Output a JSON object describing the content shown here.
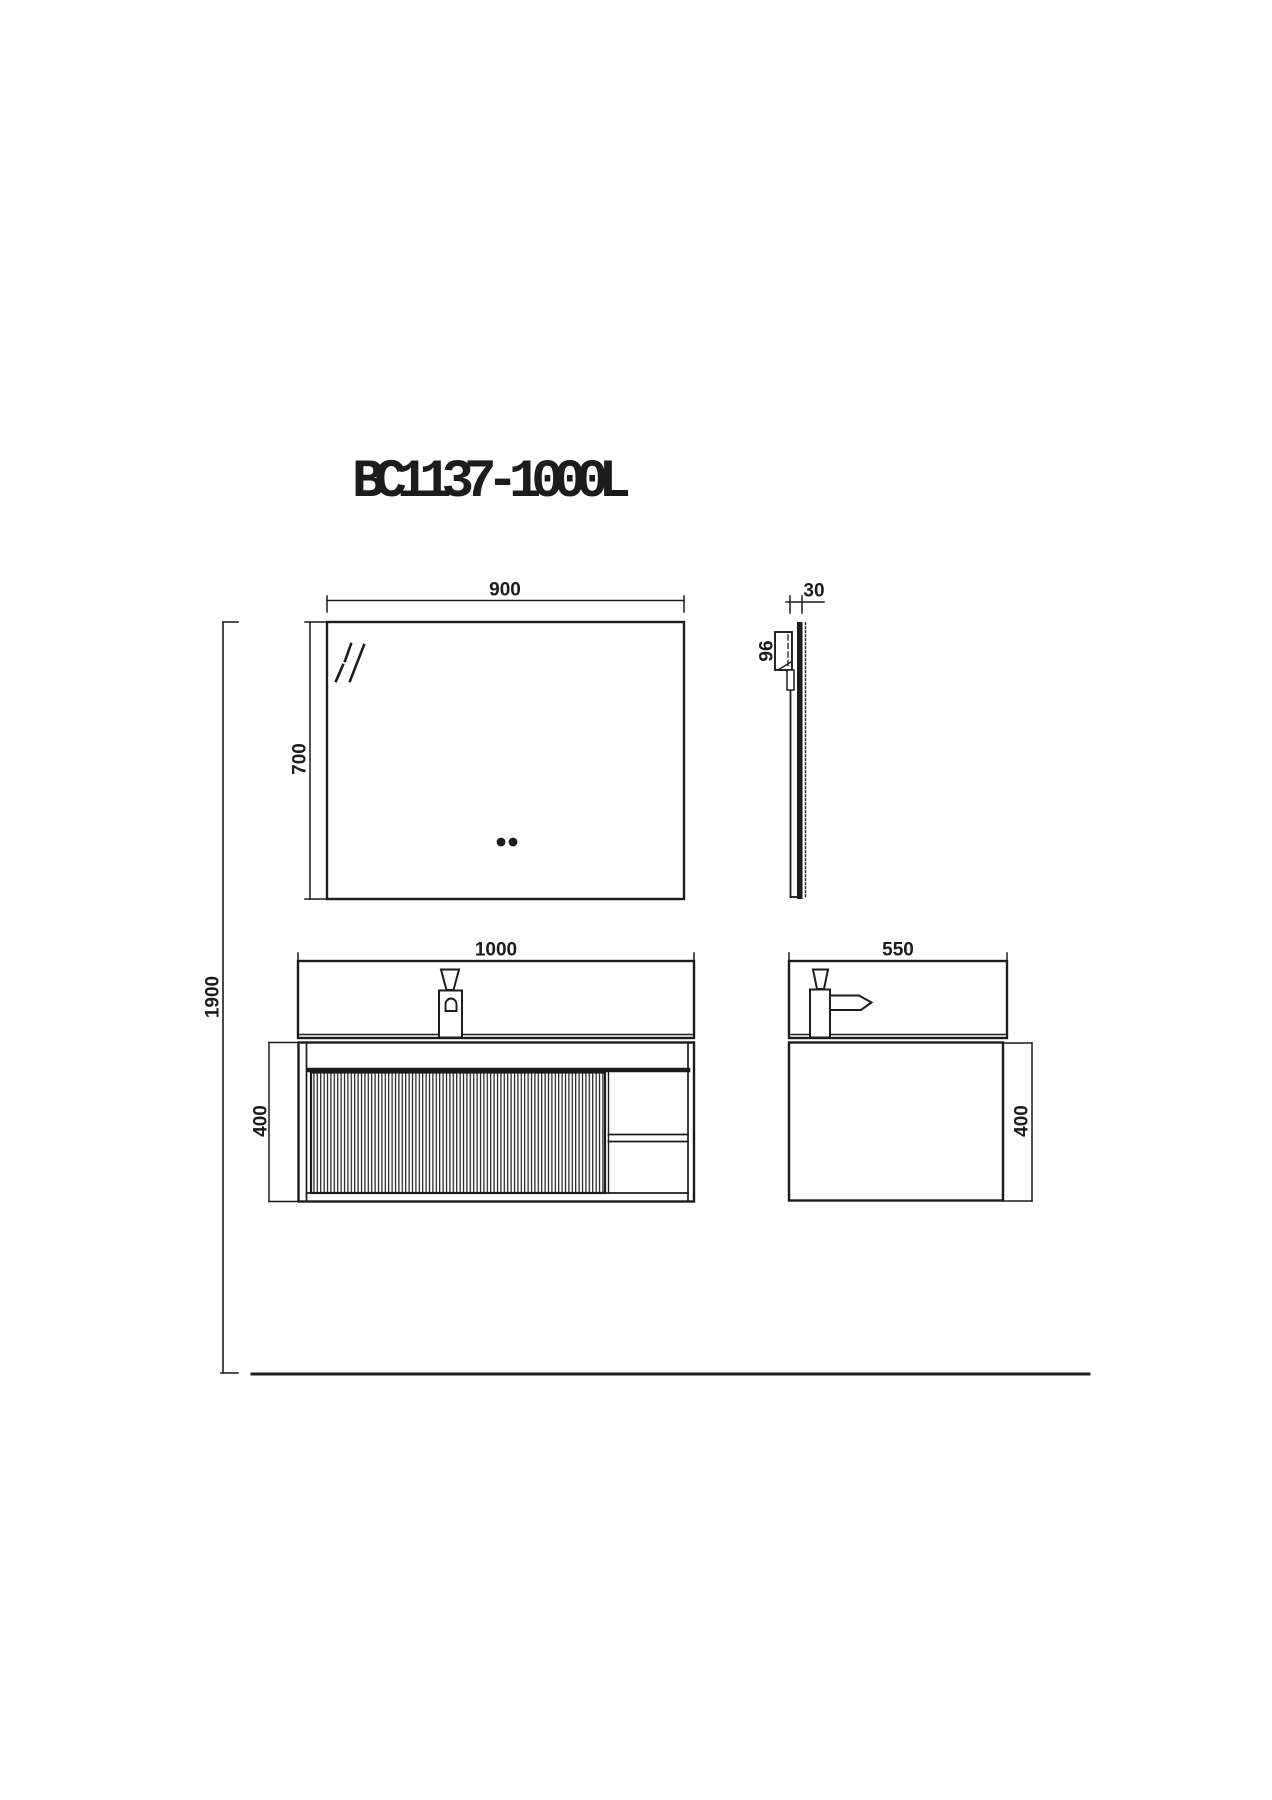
{
  "title": "BC1137-1000L",
  "dimensions": {
    "mirror_width": "900",
    "mirror_height": "700",
    "mirror_thickness": "30",
    "mirror_bracket": "96",
    "overall_height": "1900",
    "vanity_width": "1000",
    "vanity_depth": "550",
    "vanity_front_height": "400",
    "vanity_side_height": "400"
  },
  "colors": {
    "line": "#1c1c1c",
    "background": "#ffffff"
  }
}
